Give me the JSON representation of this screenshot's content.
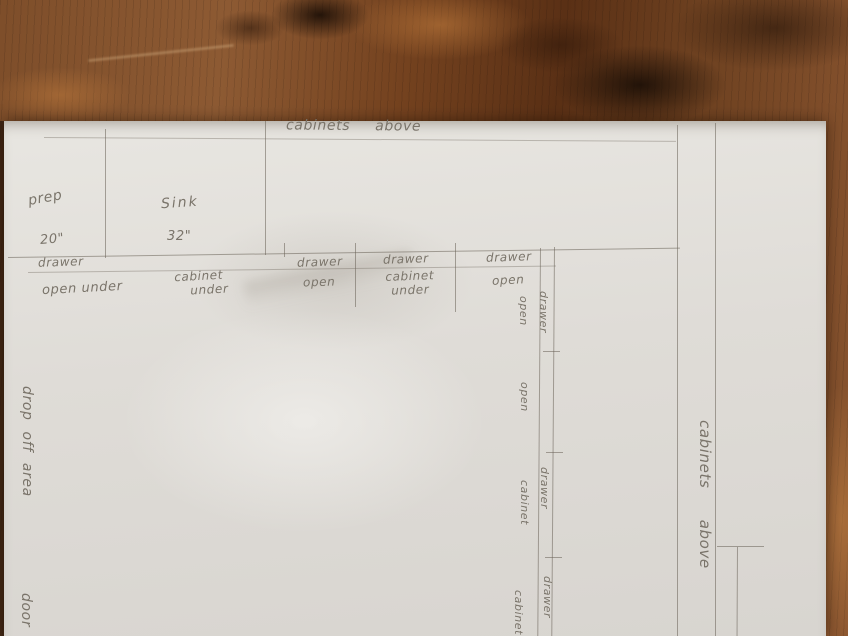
{
  "sketch": {
    "upper_note": "cabinets above",
    "right_note": "cabinets above",
    "left_note": "drop off area",
    "door_note": "door",
    "prep": {
      "label": "prep",
      "width": "20\""
    },
    "sink": {
      "label": "Sink",
      "width": "32\""
    },
    "base_row": [
      {
        "top": "drawer",
        "bottom": "open under"
      },
      {
        "line1": "cabinet",
        "line2": "under"
      },
      {
        "top": "drawer",
        "bottom": "open"
      },
      {
        "top": "drawer",
        "line1": "cabinet",
        "line2": "under"
      },
      {
        "top": "drawer",
        "bottom": "open"
      }
    ],
    "right_run": [
      {
        "strip": "drawer",
        "side": "open"
      },
      {
        "side": "open"
      },
      {
        "strip": "drawer",
        "side": "cabinet"
      },
      {
        "strip": "drawer",
        "side": "cabinet"
      }
    ],
    "colors": {
      "pencil": "#696258",
      "handwriting": "#7a746a",
      "paper": "#dedbd5",
      "wood_light": "#a9713f",
      "wood_mid": "#824f2b",
      "wood_dark": "#3a2112"
    }
  }
}
